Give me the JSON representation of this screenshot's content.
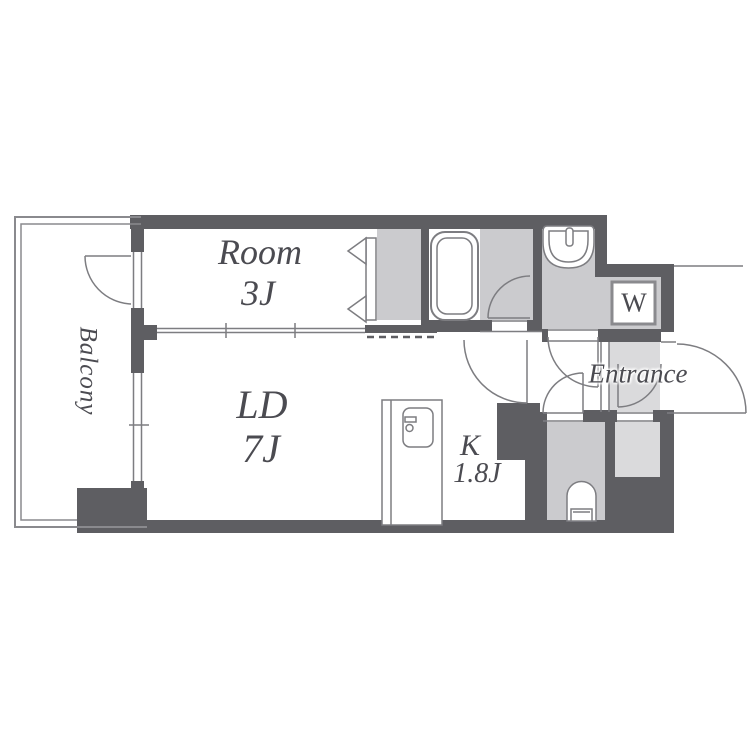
{
  "rooms": {
    "western_room": {
      "name": "Room",
      "size": "3J"
    },
    "living_dining": {
      "name": "LD",
      "size": "7J"
    },
    "kitchen": {
      "name": "K",
      "size": "1.8J"
    }
  },
  "labels": {
    "balcony": "Balcony",
    "entrance": "Entrance",
    "washer": "W"
  },
  "colors": {
    "wall": "#5e5e62",
    "fill-mid": "#cbcbce",
    "fill-light": "#dadadc",
    "line": "#7d7d81",
    "outline": "#8a8a8e",
    "text": "#4b4b51",
    "background": "#ffffff"
  }
}
